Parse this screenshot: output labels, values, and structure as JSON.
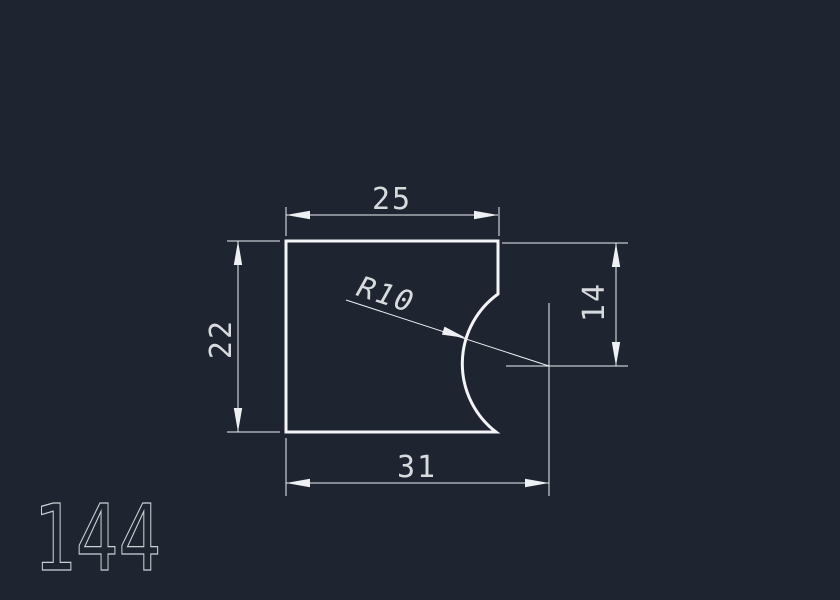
{
  "viewport": {
    "background_color": "#1e2430",
    "line_color": "#f2f4f6",
    "text_color": "#d8dbde"
  },
  "drawing": {
    "number": "144",
    "dimensions": {
      "top_width": "25",
      "left_height": "22",
      "right_offset": "14",
      "bottom_width": "31",
      "arc_radius": "R10"
    }
  }
}
